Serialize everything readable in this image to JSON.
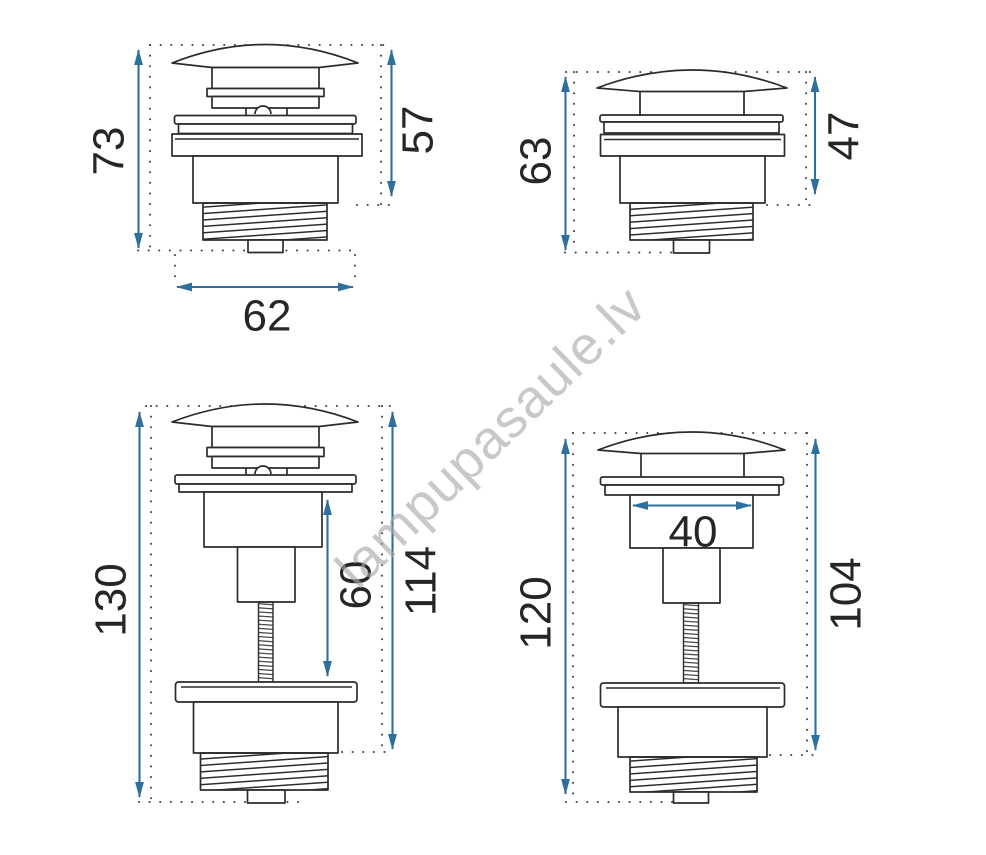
{
  "watermark": {
    "text": "lampupasaule.lv"
  },
  "colors": {
    "dimension_line": "#2d6f9d",
    "outline": "#2c2c2c",
    "watermark_gray": "#a8a8a8",
    "background": "#ffffff"
  },
  "drawings": {
    "top_left": {
      "height_left": "73",
      "height_right": "57",
      "width_bottom": "62"
    },
    "top_right": {
      "height_left": "63",
      "height_right": "47"
    },
    "bottom_left": {
      "height_left": "130",
      "height_inner": "60",
      "height_right": "114"
    },
    "bottom_right": {
      "height_left": "120",
      "width_inner": "40",
      "height_right": "104"
    }
  }
}
